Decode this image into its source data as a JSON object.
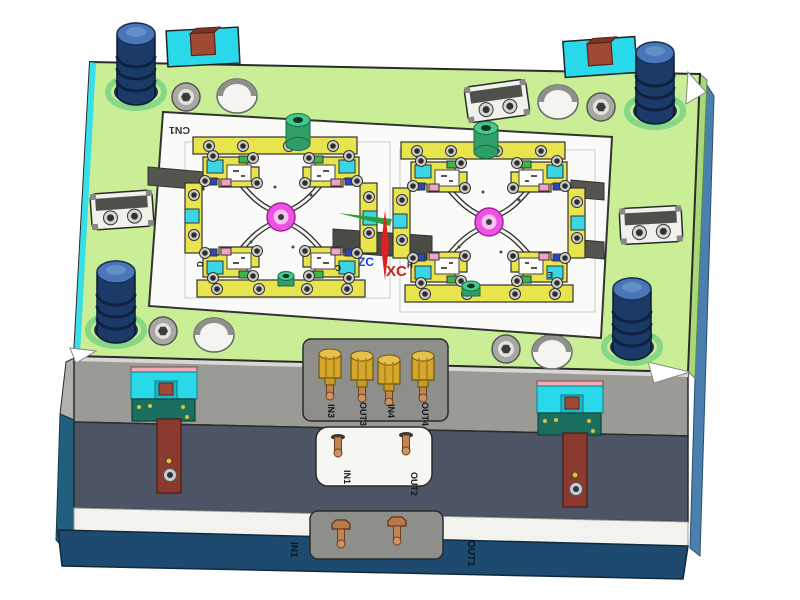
{
  "labels": {
    "plate_id": "CN1",
    "wcs": {
      "x_axis": "XC",
      "z_axis": "ZC"
    },
    "cavity_marks": {
      "left_outer": "D",
      "left_center": "C",
      "center_right": "H",
      "right_outer": "E"
    },
    "ports": {
      "manifold": [
        "IN3",
        "OUT3",
        "IN4",
        "OUT4"
      ],
      "mid": [
        "IN1",
        "OUT2"
      ],
      "base": [
        "IN1",
        "OUT1"
      ]
    }
  },
  "palette": {
    "background": "#ffffff",
    "top_plate_green": "#c9ee96",
    "plate_edge_cyan": "#39dfe8",
    "cavity_plate_white": "#fafaf8",
    "front_a_plate_gray": "#9b9b96",
    "front_b_plate_slate": "#4d5465",
    "base_plate_blue": "#1d4a6e",
    "side_strip_blue": "#4a7fae",
    "support_pillar_navy": "#1c3a68",
    "pillar_cap_blue": "#4a76b8",
    "brass_gold": "#d4a62c",
    "copper": "#c08552",
    "clamp_cyan": "#29d9e9",
    "clamp_brown": "#a04a36",
    "latch_strap_brown": "#8a3a2e",
    "latch_base_green": "#1a6f5f",
    "latch_pink": "#f0aab4",
    "sprue_magenta": "#ee52e2",
    "insert_yellow": "#e8e44e",
    "insert_cyan": "#3ad6e6",
    "insert_green": "#3cb54a",
    "insert_pink": "#f2a0cc",
    "wcs_x_red": "#c32222",
    "wcs_z_blue": "#2244cc",
    "wcs_y_green": "#2f9e3f"
  }
}
